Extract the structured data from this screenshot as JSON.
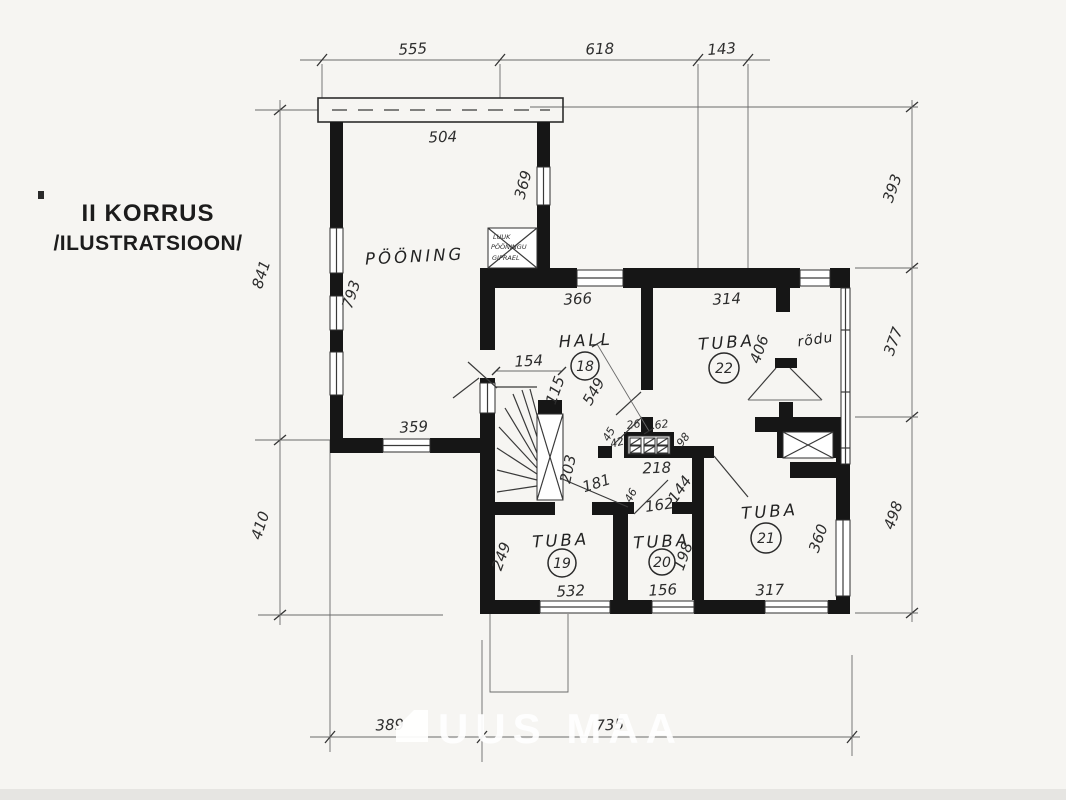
{
  "page": {
    "title_line1": "II KORRUS",
    "title_line2": "/ILUSTRATSIOON/",
    "watermark": "UUS MAA",
    "background": "#f6f5f2",
    "wall_color": "#161616",
    "ink_color": "#2d2d2d"
  },
  "rooms": {
    "poening": {
      "name": "PÖÖNING"
    },
    "hall": {
      "name": "HALL",
      "number": "18"
    },
    "tuba22": {
      "name": "TUBA",
      "number": "22"
    },
    "tuba19": {
      "name": "TUBA",
      "number": "19"
    },
    "tuba20": {
      "name": "TUBA",
      "number": "20"
    },
    "tuba21": {
      "name": "TUBA",
      "number": "21"
    },
    "rodu": {
      "name": "rõdu"
    }
  },
  "hatch_note": {
    "line1": "LUUK",
    "line2": "PÖÖNINGU",
    "line3": "GIPRAEL"
  },
  "dims": {
    "top_555": "555",
    "top_618": "618",
    "top_143": "143",
    "roof_504": "504",
    "attic_793": "793",
    "attic_369": "369",
    "attic_359": "359",
    "left_841": "841",
    "left_410": "410",
    "right_393": "393",
    "right_377": "377",
    "right_498": "498",
    "bottom_389": "389",
    "bottom_735": "735",
    "hall_366": "366",
    "hall_154": "154",
    "hall_115": "115",
    "hall_549": "549",
    "hall_203": "203",
    "hall_181": "181",
    "tuba22_314": "314",
    "tuba22_406": "406",
    "chimney_26": "26",
    "chimney_62": "62",
    "chimney_42": "42",
    "chimney_45": "45",
    "chimney_98": "98",
    "chimney_218": "218",
    "door_46": "46",
    "door_162": "162",
    "door_144": "144",
    "tuba19_249": "249",
    "tuba19_532": "532",
    "tuba20_156": "156",
    "tuba20_198": "198",
    "tuba21_317": "317",
    "tuba21_360": "360"
  }
}
